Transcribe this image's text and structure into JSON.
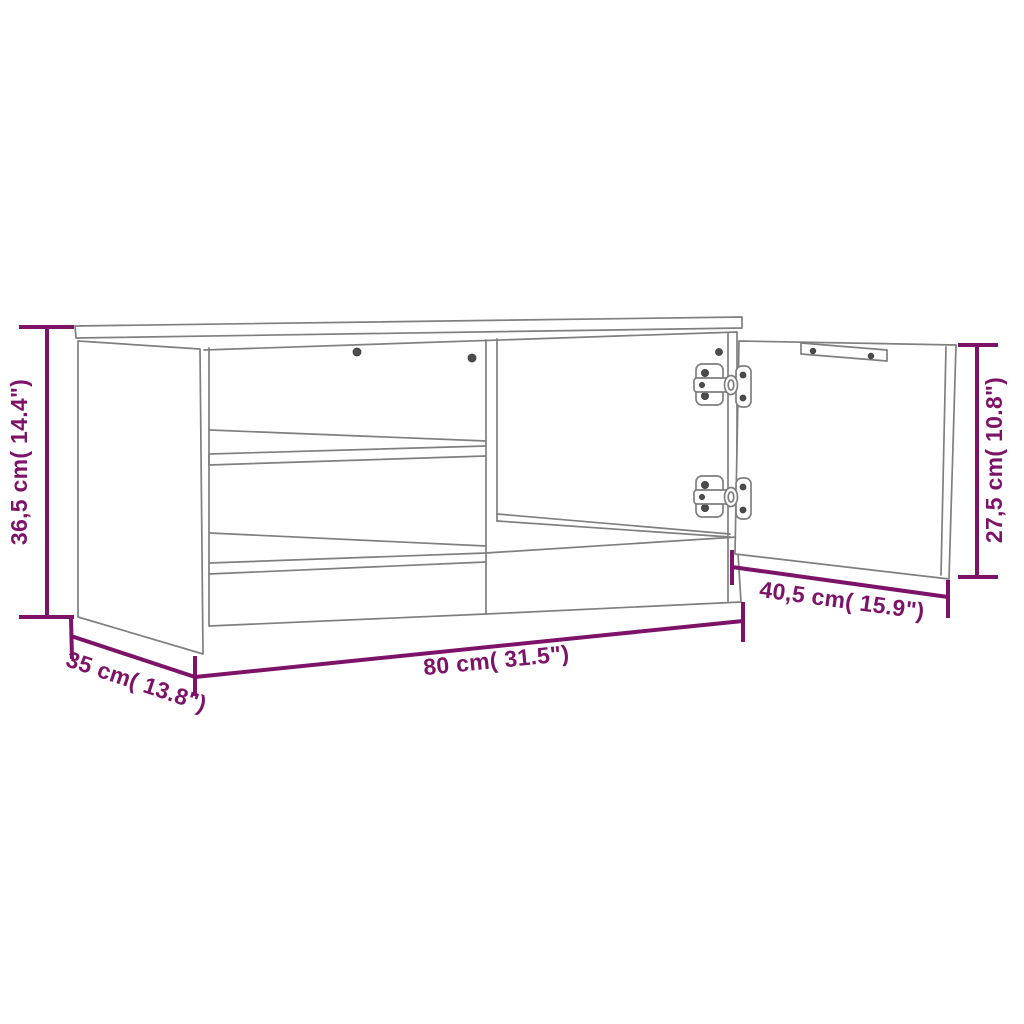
{
  "diagram": {
    "subject": "tv-cabinet-dimension-line-drawing",
    "background": "#ffffff",
    "accent_color": "#7d1368",
    "line_color": "#7f7f7f",
    "labels": {
      "height": "36,5 cm( 14.4\")",
      "depth": "35 cm( 13.8\")",
      "width": "80 cm( 31.5\")",
      "door_width": "40,5 cm( 15.9\")",
      "door_height": "27,5 cm( 10.8\")"
    }
  }
}
